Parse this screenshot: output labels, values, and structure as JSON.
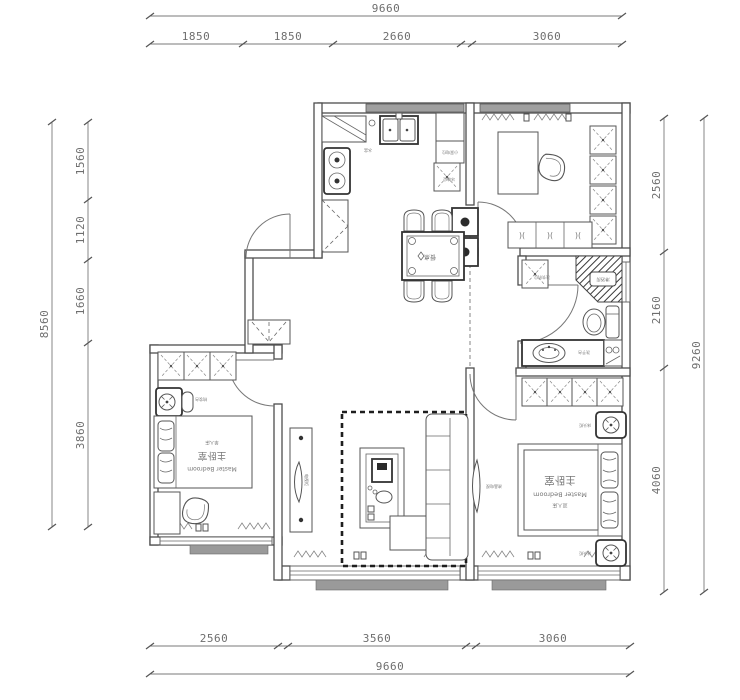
{
  "dimensions": {
    "top": {
      "total": "9660",
      "segments": [
        "1850",
        "1850",
        "2660",
        "3060"
      ]
    },
    "bottom": {
      "total": "9660",
      "segments": [
        "2560",
        "3560",
        "3060"
      ]
    },
    "left": {
      "total": "8560",
      "segments": [
        "1560",
        "1120",
        "1660",
        "3860"
      ]
    },
    "right": {
      "total": "9260",
      "segments": [
        "2560",
        "2160",
        "4060"
      ]
    }
  },
  "rooms": {
    "secondary_bedroom": {
      "name_cn": "主卧室",
      "name_en": "Master Bedroom",
      "bed_label": "单人床"
    },
    "master_bedroom": {
      "name_cn": "主卧室",
      "name_en": "Master Bedroom",
      "bed_label": "双人床"
    }
  },
  "fixtures": {
    "dining_table": "餐桌",
    "tv_cabinet": "电视柜",
    "tv": "液晶电视",
    "fridge": "冰箱位",
    "small_appliance": "小家电位",
    "sink": "水盆",
    "washing_machine": "洗衣机位",
    "shower": "淋浴房",
    "vanity": "洗手台",
    "nightstand_top": "床头柜",
    "nightstand_bottom": "床头柜",
    "dresser": "梳妆台"
  },
  "colors": {
    "wall": "#4d4d4d",
    "window": "#a0a0a0",
    "dimension": "#6e6e6e",
    "hatch": "#3a3a3a"
  }
}
